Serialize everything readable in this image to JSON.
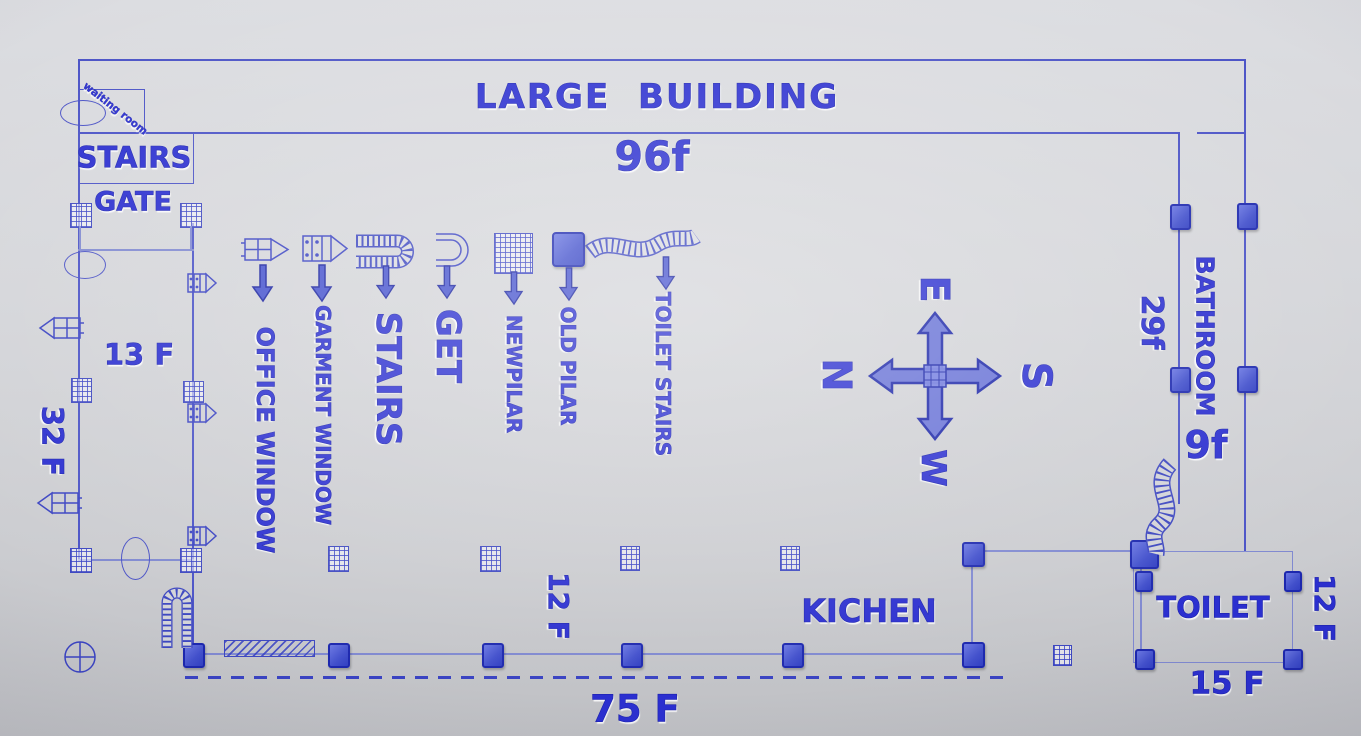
{
  "title": {
    "name": "LARGE  BUILDING",
    "width_label": "96f"
  },
  "top_left": {
    "waiting_room": "waiting room",
    "stairs": "STAIRS",
    "gate": "GATE"
  },
  "dimensions": {
    "inner_left": "13 F",
    "outer_left": "32 F",
    "bathroom_length": "29f",
    "bathroom_width": "9f",
    "kitchen_depth": "12 F",
    "bottom_span": "75 F",
    "toilet_side": "12 F",
    "toilet_front": "15 F"
  },
  "rooms": {
    "bathroom": "BATHROOM",
    "kitchen": "KICHEN",
    "toilet": "TOILET"
  },
  "legend": [
    {
      "label": "OFFICE WINDOW",
      "icon": "office-window-icon"
    },
    {
      "label": "GARMENT WINDOW",
      "icon": "garment-window-icon"
    },
    {
      "label": "STAIRS",
      "icon": "stairs-icon"
    },
    {
      "label": "GET",
      "icon": "get-icon"
    },
    {
      "label": "NEWPILAR",
      "icon": "new-pillar-icon"
    },
    {
      "label": "OLD PILAR",
      "icon": "old-pillar-icon"
    },
    {
      "label": "TOILET STAIRS",
      "icon": "toilet-stairs-icon"
    }
  ],
  "compass": {
    "up": "E",
    "left": "N",
    "right": "S",
    "down": "W"
  },
  "colors": {
    "ink": "#2b2fd0",
    "wall": "#4a52c6",
    "pillar_fill": "#4250cc",
    "pillar_stroke": "#1d28ae",
    "background": "#d4d5d9"
  }
}
